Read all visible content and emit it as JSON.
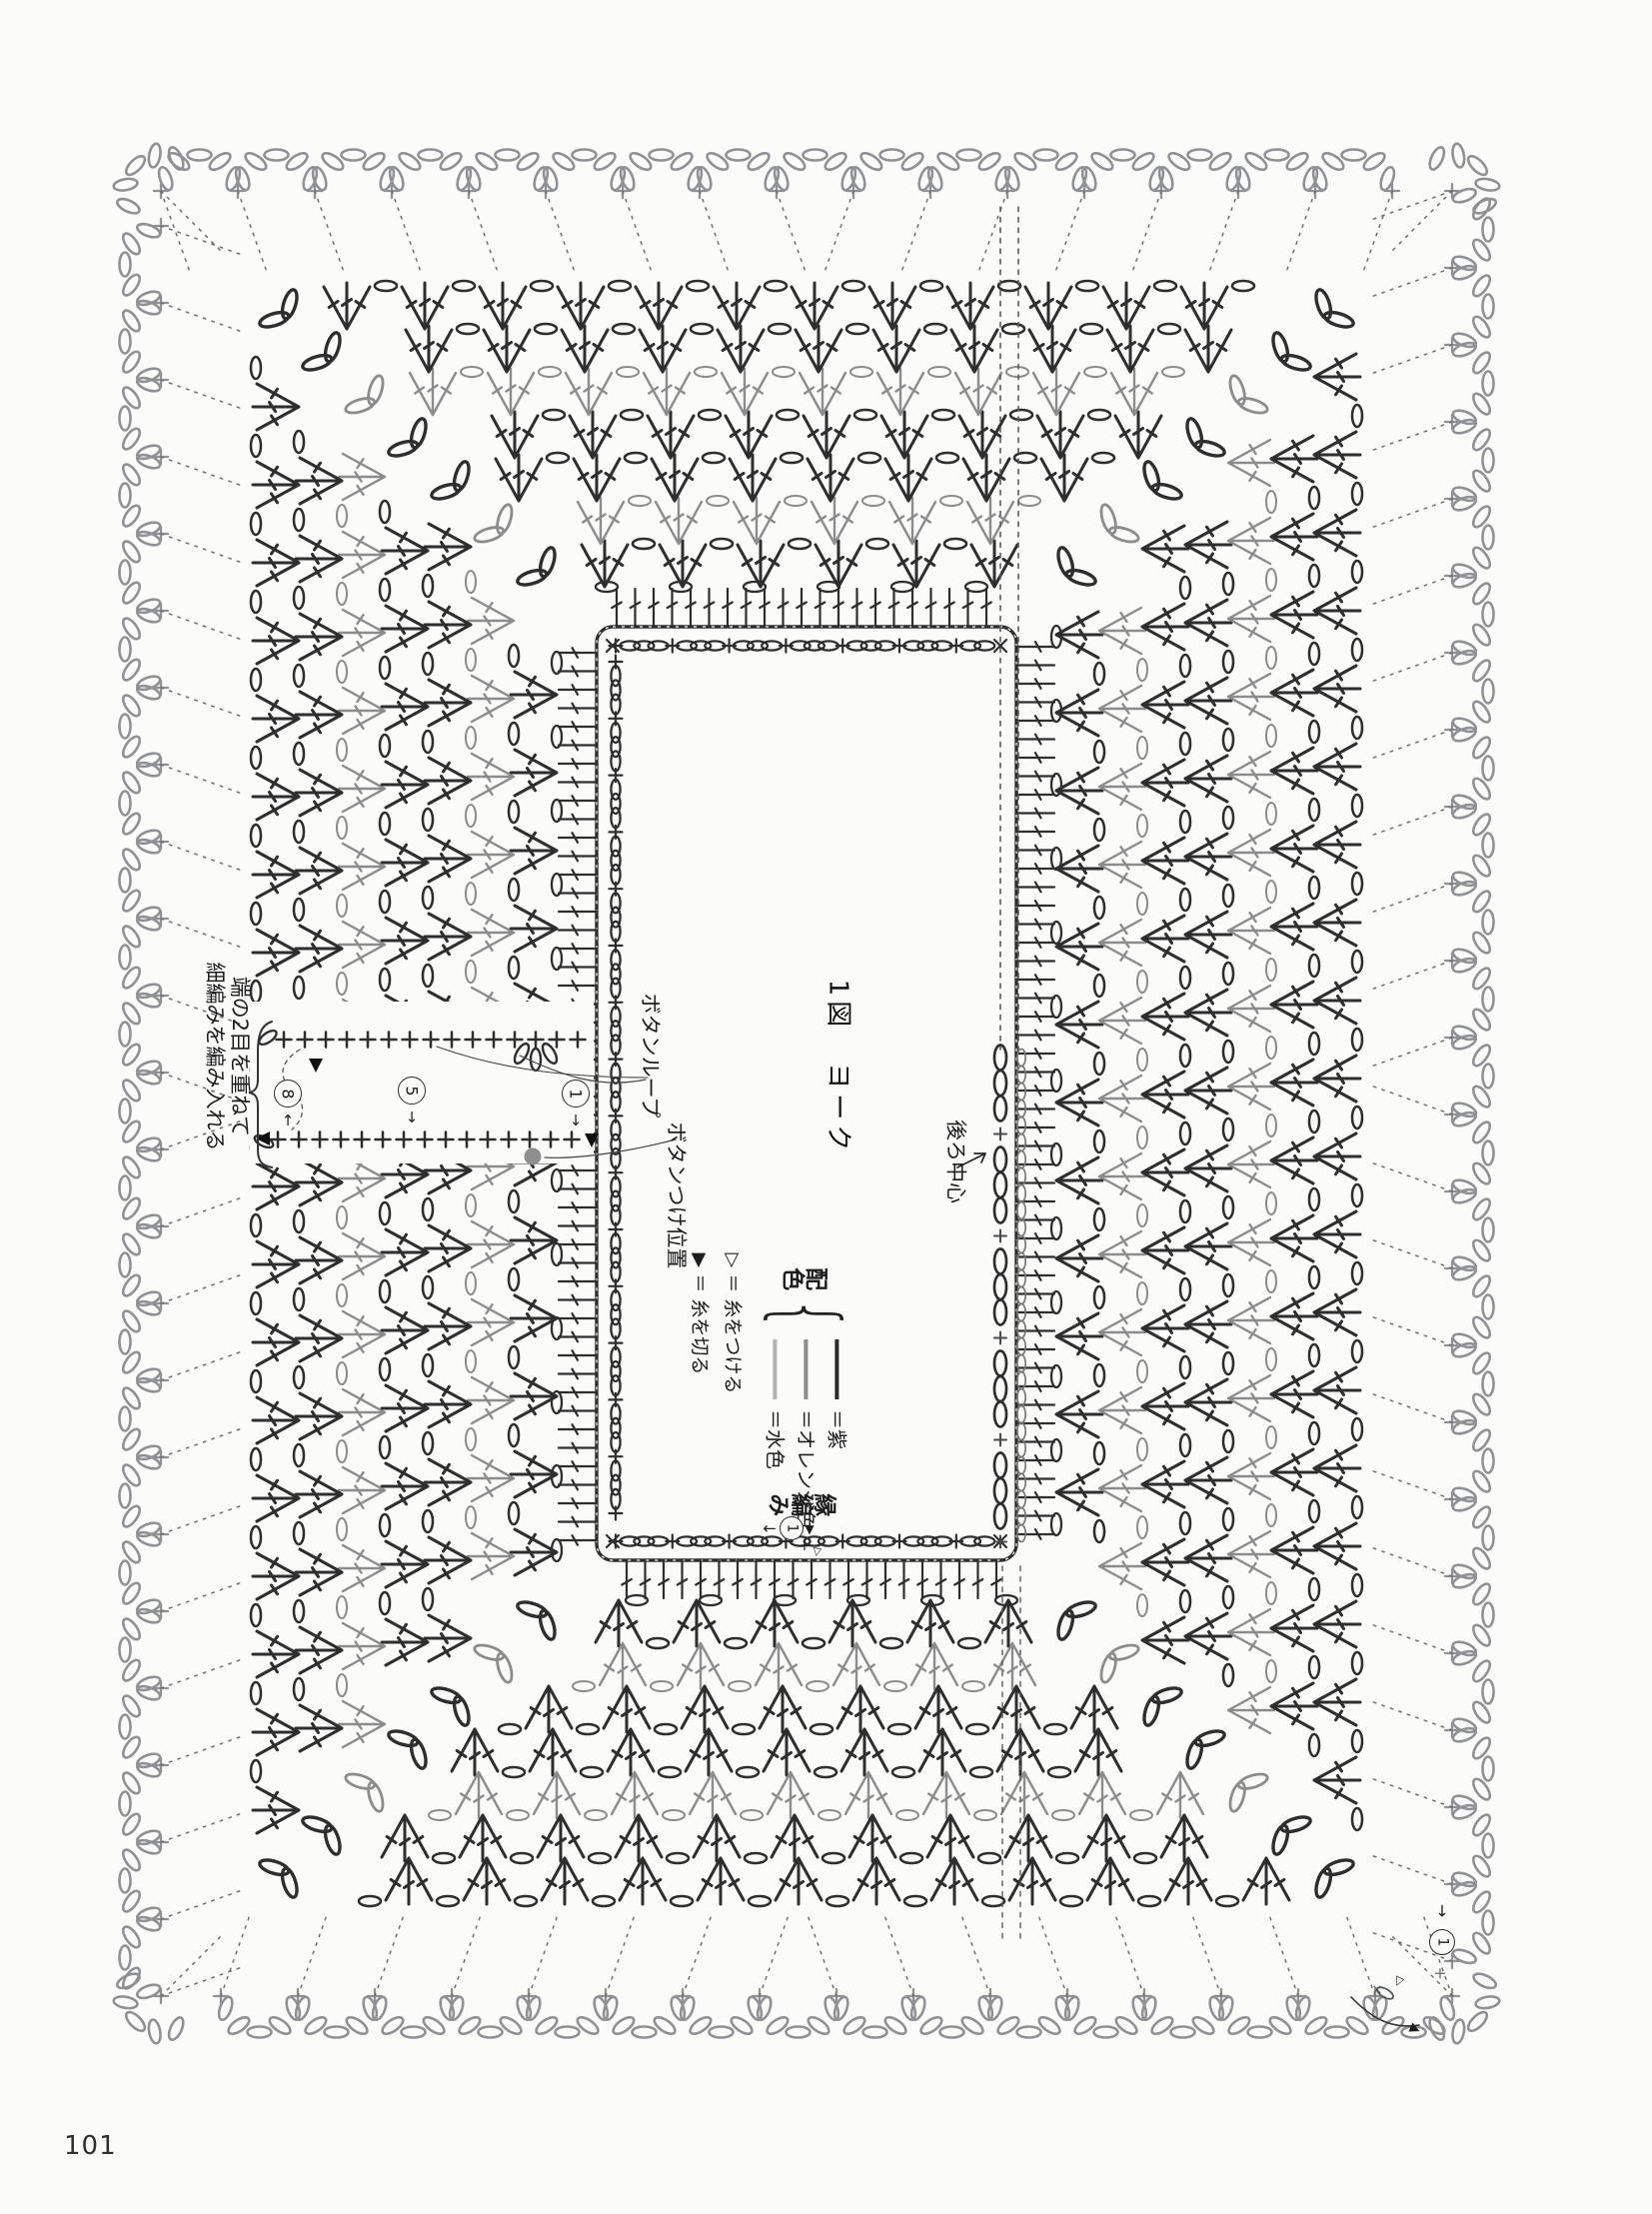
{
  "page": {
    "number": "101"
  },
  "figure": {
    "title": "1図　ヨーク"
  },
  "labels": {
    "back_center": "後ろ中心",
    "edging": "縁編み",
    "button_loop": "ボタンループ",
    "button_position": "ボタンつけ位置",
    "slit_note": "端の2目を重ねて\n細編みを編み入れる"
  },
  "legend": {
    "heading": "配色",
    "brace": "{",
    "items": [
      {
        "label": "＝紫",
        "color": "#2a2a2a"
      },
      {
        "label": "＝オレンジ色",
        "color": "#8c8c8c"
      },
      {
        "label": "＝水色",
        "color": "#b4b4b4"
      }
    ],
    "marks": [
      {
        "symbol": "▷",
        "label": "＝ 糸をつける"
      },
      {
        "symbol": "▶",
        "label": "＝ 糸を切る"
      }
    ]
  },
  "row_numbers": {
    "slit": [
      {
        "n": "8",
        "arrow": "↑"
      },
      {
        "n": "5",
        "arrow": "↓"
      },
      {
        "n": "1",
        "arrow": "↓"
      }
    ],
    "neck_edging_start": {
      "arrow": "←",
      "n": "1",
      "cut_mark": "▼",
      "plus": "+",
      "attach_mark": "▷"
    },
    "outer_edging_start": {
      "arrow": "↓",
      "n": "1",
      "plus": "+",
      "cross": "×",
      "attach_mark": "▷",
      "cut_mark": "▶"
    }
  },
  "diagram": {
    "colors": {
      "dark": "#2e2e2e",
      "mid": "#8c8c8c",
      "light": "#b4b4b4",
      "scallop": "#8f9194",
      "dotted": "#6e6e6e",
      "accent_dot": "#8f8f8f"
    },
    "rounds": [
      {
        "type": "plain-dc",
        "color_key": "dark"
      },
      {
        "type": "shell",
        "color_key": "dark"
      },
      {
        "type": "shell",
        "color_key": "mid"
      },
      {
        "type": "shell",
        "color_key": "dark"
      },
      {
        "type": "shell",
        "color_key": "dark"
      },
      {
        "type": "shell",
        "color_key": "mid"
      },
      {
        "type": "shell",
        "color_key": "dark"
      },
      {
        "type": "shell",
        "color_key": "dark"
      }
    ],
    "edging": {
      "type": "scallop",
      "color_key": "scallop"
    }
  }
}
